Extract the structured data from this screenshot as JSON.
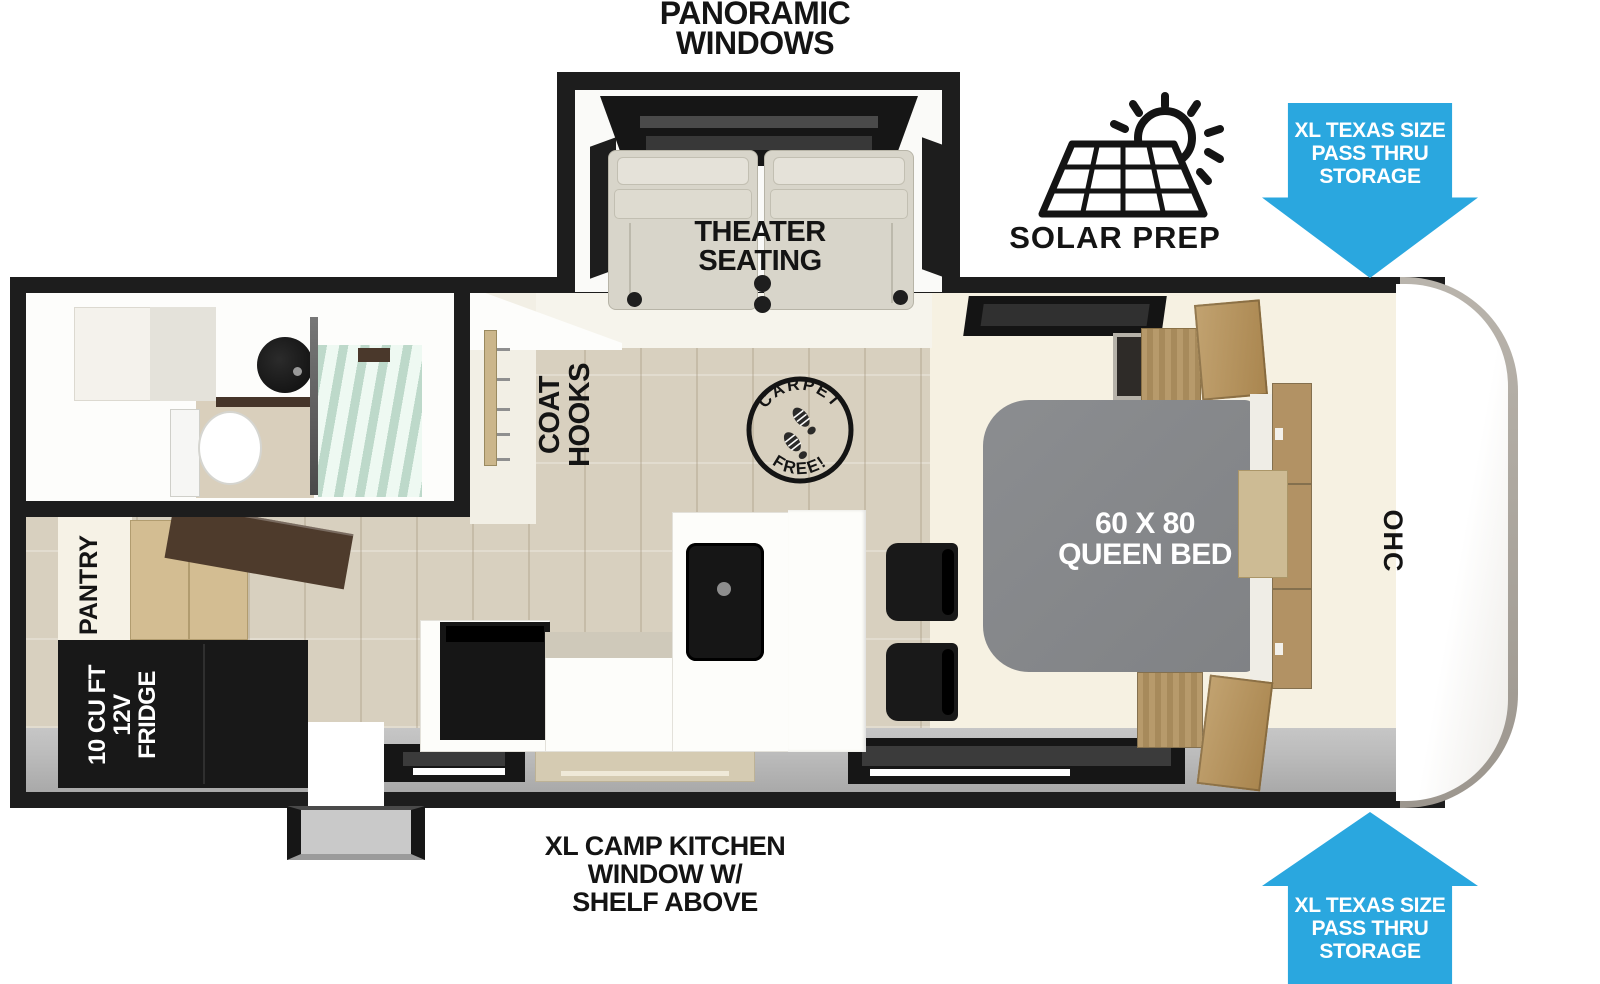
{
  "annotations": {
    "panoramic_windows": {
      "line1": "PANORAMIC",
      "line2": "WINDOWS"
    },
    "theater_seating": {
      "line1": "THEATER",
      "line2": "SEATING"
    },
    "solar_prep": "SOLAR PREP",
    "storage_arrow_top": {
      "line1": "XL TEXAS SIZE",
      "line2": "PASS THRU",
      "line3": "STORAGE"
    },
    "storage_arrow_bottom": {
      "line1": "XL TEXAS SIZE",
      "line2": "PASS THRU",
      "line3": "STORAGE"
    },
    "camp_kitchen": {
      "line1": "XL CAMP KITCHEN",
      "line2": "WINDOW W/",
      "line3": "SHELF ABOVE"
    }
  },
  "interior_labels": {
    "coat_hooks": {
      "line1": "COAT",
      "line2": "HOOKS"
    },
    "carpet_free": {
      "top": "CARPET",
      "bottom": "FREE!"
    },
    "queen_bed": {
      "line1": "60 X 80",
      "line2": "QUEEN BED"
    },
    "ohc": "OHC",
    "pantry": "PANTRY",
    "fridge": {
      "line1": "10 CU FT",
      "line2": "12V",
      "line3": "FRIDGE"
    }
  },
  "colors": {
    "arrow_blue": "#2AA7DF",
    "outline": "#1d1d1d",
    "black_fixture": "#161616",
    "wood_floor": "#d8d0bf",
    "cream": "#f6f1e2",
    "interior_white": "#f6f4ee",
    "gray_band": "#bcbcbc",
    "bed_gray": "#86888b",
    "seat_beige": "#d8d5ca",
    "cabinet_tan": "#d3bd92",
    "door_wood": "#b29264",
    "dark_wood": "#4e3b2c",
    "glass_green": "#cfe2d6",
    "cap_silver": "#9c968e"
  }
}
